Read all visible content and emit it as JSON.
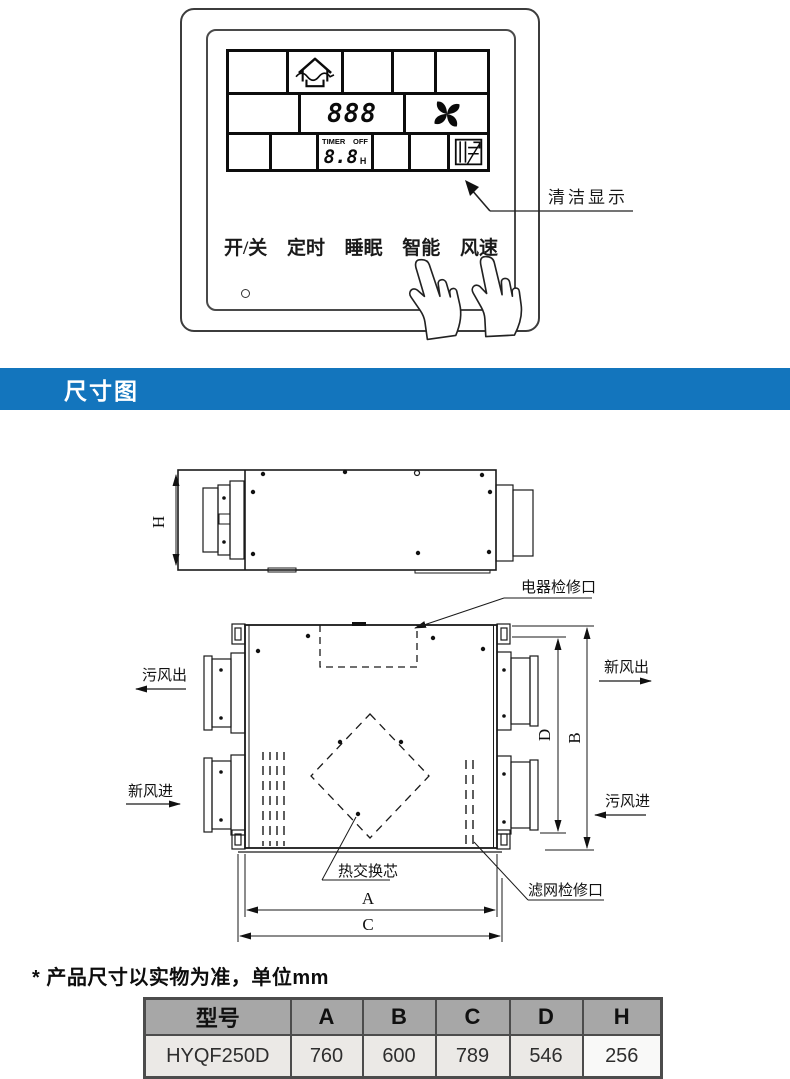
{
  "panel": {
    "display": {
      "mode_digits": "888",
      "timer_label": "TIMER",
      "timer_state": "OFF",
      "timer_digits": "8.8",
      "timer_unit": "H"
    },
    "buttons": [
      {
        "label": "开/关"
      },
      {
        "label": "定时"
      },
      {
        "label": "睡眠"
      },
      {
        "label": "智能"
      },
      {
        "label": "风速"
      }
    ],
    "callout_label": "清洁显示",
    "icons": {
      "mode": "house-ventilation-icon",
      "fan": "fan-icon",
      "clean": "clean-indicator-icon",
      "hands": "pointing-hand-icon"
    }
  },
  "banner": {
    "title": "尺寸图",
    "color": "#1375bd"
  },
  "drawing": {
    "labels": {
      "electrical_access": "电器检修口",
      "dirty_air_out": "污风出",
      "fresh_air_in": "新风进",
      "fresh_air_out": "新风出",
      "dirty_air_in": "污风进",
      "heat_core": "热交换芯",
      "filter_access": "滤网检修口"
    },
    "dims": {
      "h": "H",
      "d": "D",
      "b": "B",
      "a": "A",
      "c": "C"
    }
  },
  "note": "* 产品尺寸以实物为准，单位mm",
  "spec_table": {
    "headers": [
      "型号",
      "A",
      "B",
      "C",
      "D",
      "H"
    ],
    "rows": [
      {
        "model": "HYQF250D",
        "a": "760",
        "b": "600",
        "c": "789",
        "d": "546",
        "h": "256"
      }
    ]
  }
}
